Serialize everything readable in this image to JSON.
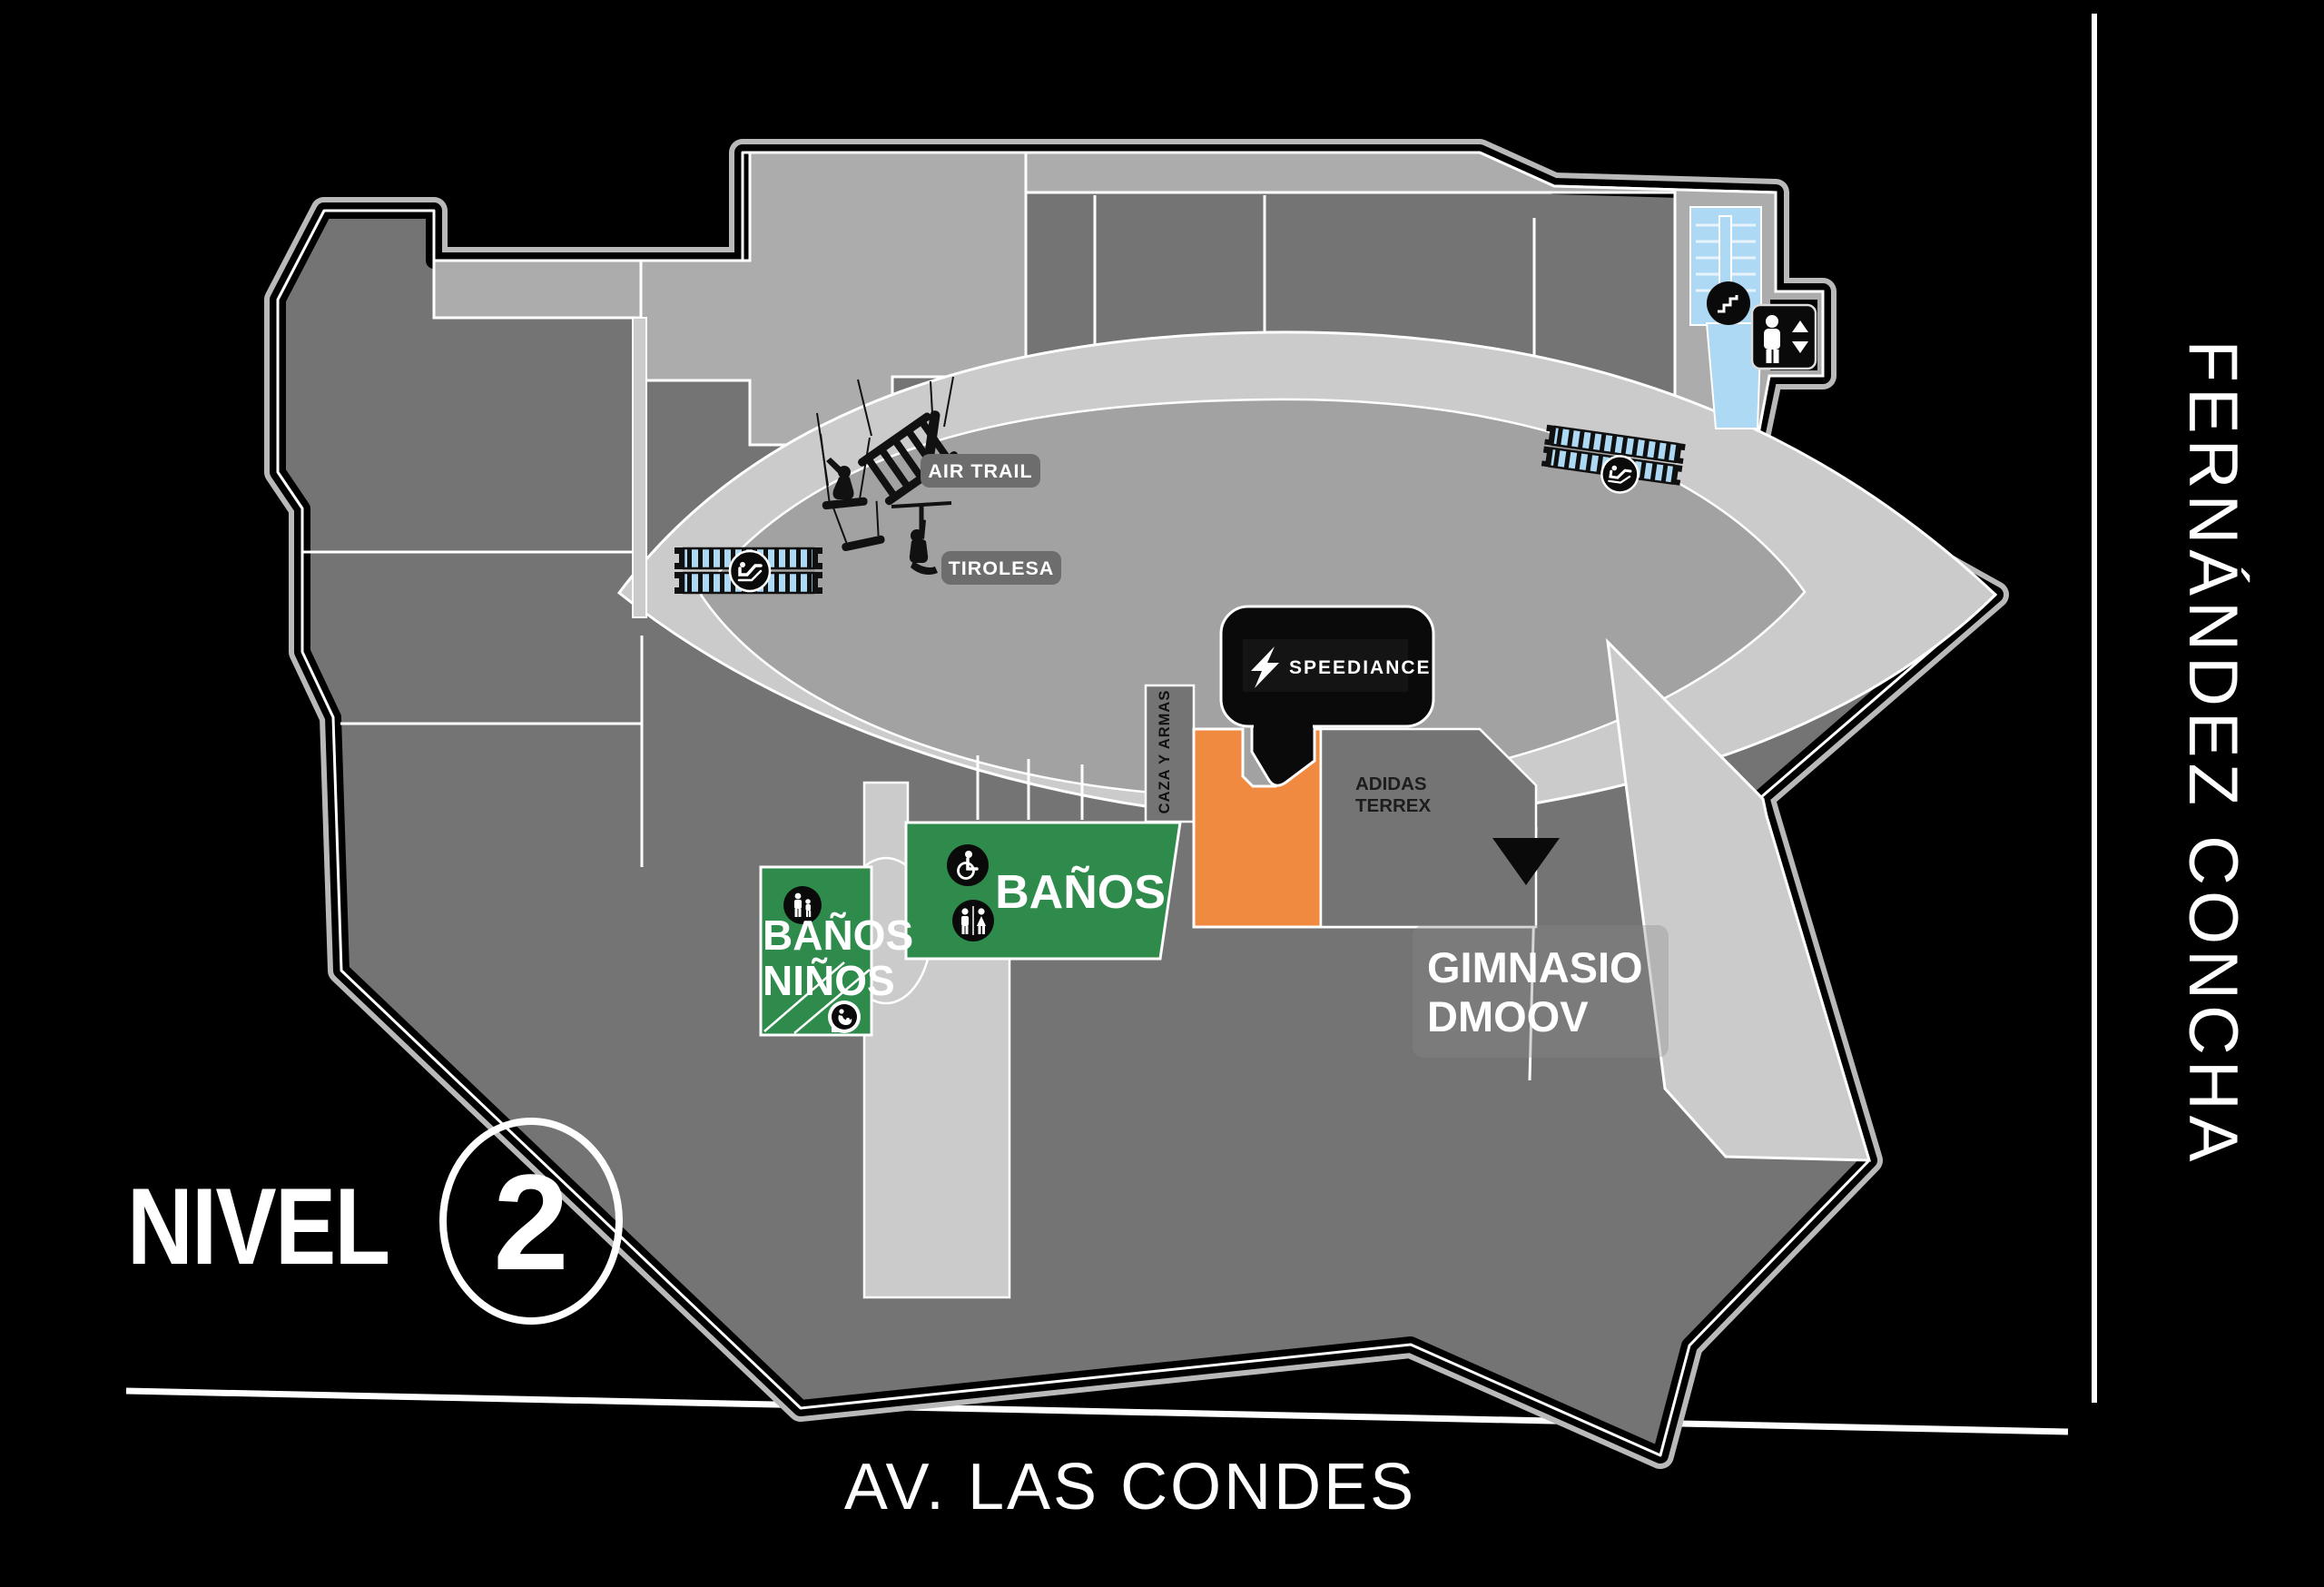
{
  "level": {
    "label": "NIVEL",
    "number": "2"
  },
  "streets": {
    "right_street": "FERNÁNDEZ CONCHA",
    "bottom_street": "AV. LAS CONDES"
  },
  "attractions": {
    "air_trail": "AIR TRAIL",
    "tirolesa": "TIROLESA"
  },
  "stores": {
    "speediance": "SPEEDIANCE",
    "adidas_line1": "ADIDAS",
    "adidas_line2": "TERREX",
    "caza_y_armas": "CAZA Y ARMAS",
    "gimnasio_line1": "GIMNASIO",
    "gimnasio_line2": "DMOOV"
  },
  "amenities": {
    "banos": "BAÑOS",
    "banos_ninos_line1": "BAÑOS",
    "banos_ninos_line2": "NIÑOS"
  },
  "icons": {
    "stairs": "stairs-icon",
    "elevator": "elevator-icon",
    "escalator": "escalator-icon",
    "restrooms": "men-women-icon",
    "accessible": "wheelchair-icon",
    "family": "family-icon",
    "nursing": "baby-care-icon",
    "air_trail": "climber-silhouette-icon",
    "tirolesa": "zipline-silhouette-icon",
    "highlight_pointer": "triangle-pointer-icon",
    "speediance_logo": "speediance-s-logo-icon"
  },
  "colors": {
    "background": "#000000",
    "store_grey": "#747474",
    "walkway_grey": "#cbcbcb",
    "courtyard_grey": "#a2a2a2",
    "band_grey": "#acacac",
    "outline_grey": "#b9b9b9",
    "badge_grey": "#6d6d6d",
    "bathroom_green": "#2e8b4c",
    "highlight_orange": "#f08a40",
    "stairs_blue": "#aed9f4",
    "text_white": "#ffffff"
  }
}
